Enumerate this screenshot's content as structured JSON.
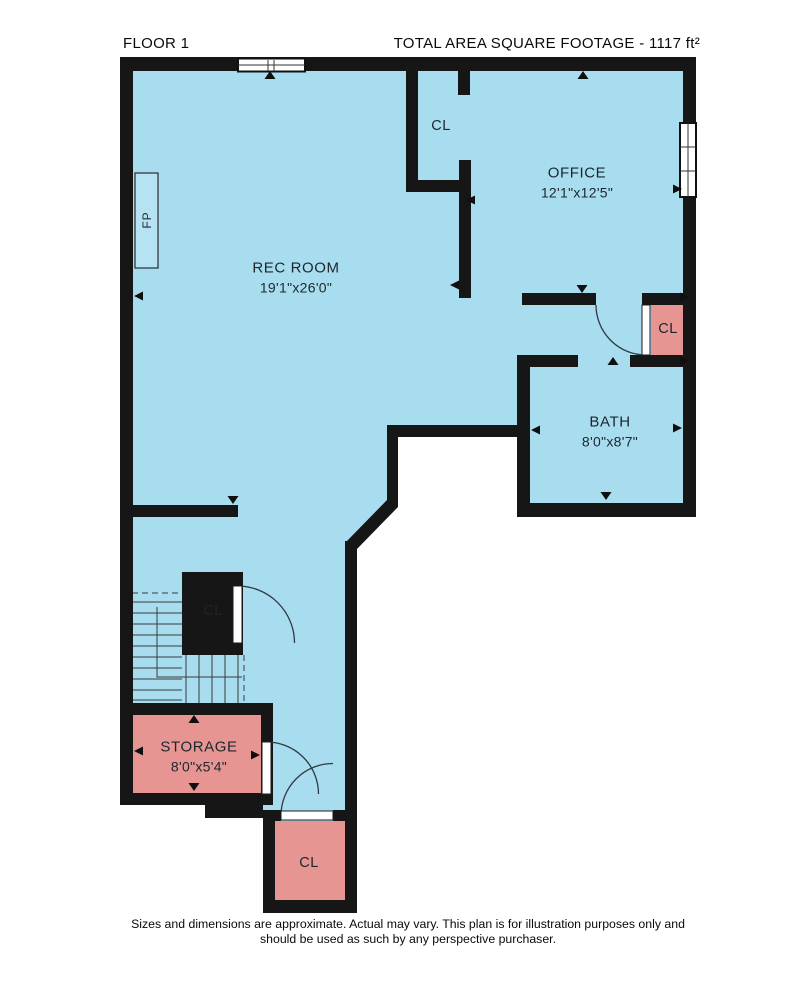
{
  "header": {
    "floor_label": "FLOOR 1",
    "area_label": "TOTAL AREA SQUARE FOOTAGE - 1117 ft²"
  },
  "rooms": [
    {
      "name": "REC ROOM",
      "dims": "19'1\"x26'0\""
    },
    {
      "name": "OFFICE",
      "dims": "12'1\"x12'5\""
    },
    {
      "name": "BATH",
      "dims": "8'0\"x8'7\""
    },
    {
      "name": "STORAGE",
      "dims": "8'0\"x5'4\""
    }
  ],
  "closets": [
    {
      "label": "CL"
    },
    {
      "label": "CL"
    },
    {
      "label": "CL"
    },
    {
      "label": "CL"
    }
  ],
  "fireplace": {
    "label": "FP"
  },
  "footer": {
    "line1": "Sizes and dimensions are approximate. Actual may vary. This plan is for illustration purposes only and",
    "line2": "should be used as such by any perspective purchaser."
  },
  "colors": {
    "floor_fill": "#a8ddf0",
    "closet_fill": "#e69592",
    "wall": "#161616"
  }
}
